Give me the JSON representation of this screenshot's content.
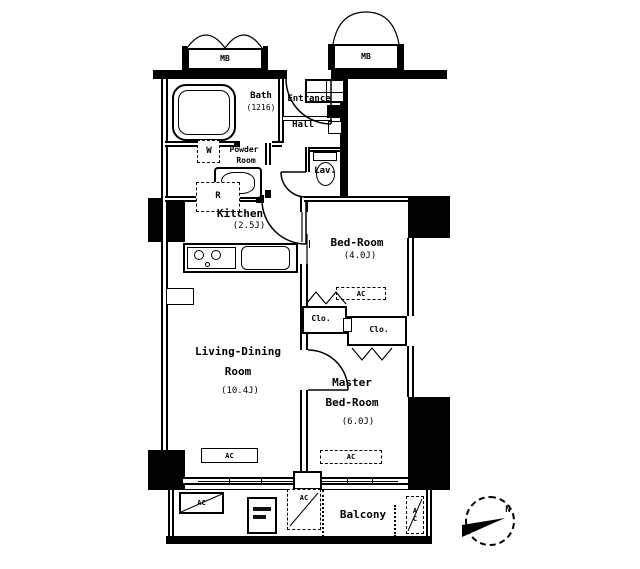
{
  "compass": {
    "north": "N"
  },
  "meter_box": {
    "left": "MB",
    "right": "MB"
  },
  "rooms": {
    "bath": {
      "name": "Bath",
      "size": "(1216)"
    },
    "entrance": {
      "name": "Entrance"
    },
    "hall": {
      "name": "Hall"
    },
    "powder_room": {
      "line1": "Powder",
      "line2": "Room"
    },
    "lavatory": {
      "name": "Lav."
    },
    "kitchen": {
      "name": "Kitchen",
      "size": "(2.5J)"
    },
    "bedroom": {
      "name": "Bed-Room",
      "size": "(4.0J)"
    },
    "living_dining": {
      "line1": "Living-Dining",
      "line2": "Room",
      "size": "(10.4J)"
    },
    "master_bedroom": {
      "line1": "Master",
      "line2": "Bed-Room",
      "size": "(6.0J)"
    },
    "balcony": {
      "name": "Balcony"
    },
    "closets": {
      "left": "Clo.",
      "right": "Clo."
    }
  },
  "fixtures": {
    "refrigerator": "R",
    "washer": "W",
    "air_conditioner": "AC"
  }
}
